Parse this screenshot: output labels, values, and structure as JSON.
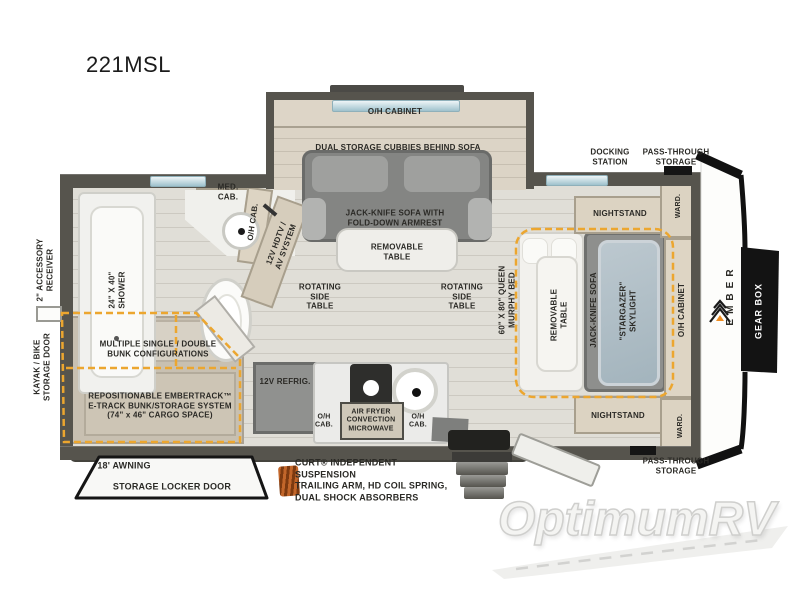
{
  "title": "221MSL",
  "watermark": "OptimumRV",
  "labels": {
    "slideout": {
      "oh_cabinet": "O/H CABINET",
      "dual_storage": "DUAL STORAGE CUBBIES BEHIND SOFA",
      "jackknife_sofa": "JACK-KNIFE SOFA WITH\nFOLD-DOWN ARMREST",
      "removable_table": "REMOVABLE\nTABLE"
    },
    "living": {
      "rotating_table_left": "ROTATING\nSIDE\nTABLE",
      "rotating_table_right": "ROTATING\nSIDE\nTABLE",
      "av_system": "12V HDTV /\nAV SYSTEM",
      "oh_cab": "O/H CAB."
    },
    "bathroom": {
      "shower": "24\" X 40\"\nSHOWER",
      "med_cab": "MED.\nCAB."
    },
    "bunk": {
      "configurations": "MULTIPLE SINGLE / DOUBLE\nBUNK CONFIGURATIONS",
      "etrack": "REPOSITIONABLE EMBERTRACK™\nE-TRACK BUNK/STORAGE SYSTEM\n(74\" x 46\" CARGO SPACE)"
    },
    "kitchen": {
      "fridge": "12V REFRIG.",
      "microwave": "AIR FRYER\nCONVECTION\nMICROWAVE",
      "oh_cab_left": "O/H\nCAB.",
      "oh_cab_right": "O/H\nCAB."
    },
    "bedroom": {
      "murphy_bed": "60\" X 80\" QUEEN\nMURPHY BED",
      "removable_table": "REMOVABLE\nTABLE",
      "jackknife_sofa": "JACK-KNIFE SOFA",
      "skylight": "\"STARGAZER\"\nSKYLIGHT",
      "nightstand_top": "NIGHTSTAND",
      "nightstand_bottom": "NIGHTSTAND",
      "ward_top": "WARD.",
      "ward_bottom": "WARD.",
      "oh_cabinet": "O/H CABINET"
    },
    "exterior": {
      "accessory_receiver": "2\" ACCESSORY\nRECEIVER",
      "kayak_door": "KAYAK / BIKE\nSTORAGE DOOR",
      "docking_station": "DOCKING\nSTATION",
      "pass_through_top": "PASS-THROUGH\nSTORAGE",
      "pass_through_bottom": "PASS-THROUGH\nSTORAGE",
      "awning": "18' AWNING",
      "storage_locker": "STORAGE LOCKER DOOR",
      "suspension": "CURT® INDEPENDENT SUSPENSION\nTRAILING ARM, HD COIL SPRING,\nDUAL SHOCK ABSORBERS",
      "gear_box": "GEAR BOX",
      "brand": "EMBER"
    }
  },
  "colors": {
    "wall": "#56544d",
    "accent_dash": "#eca62f",
    "cabinet": "#dcd3c2",
    "sofa": "#848583",
    "skylight": "#b3c0c8",
    "coil_spring": "#b55a1e",
    "gear_box_panel": "#131313"
  }
}
